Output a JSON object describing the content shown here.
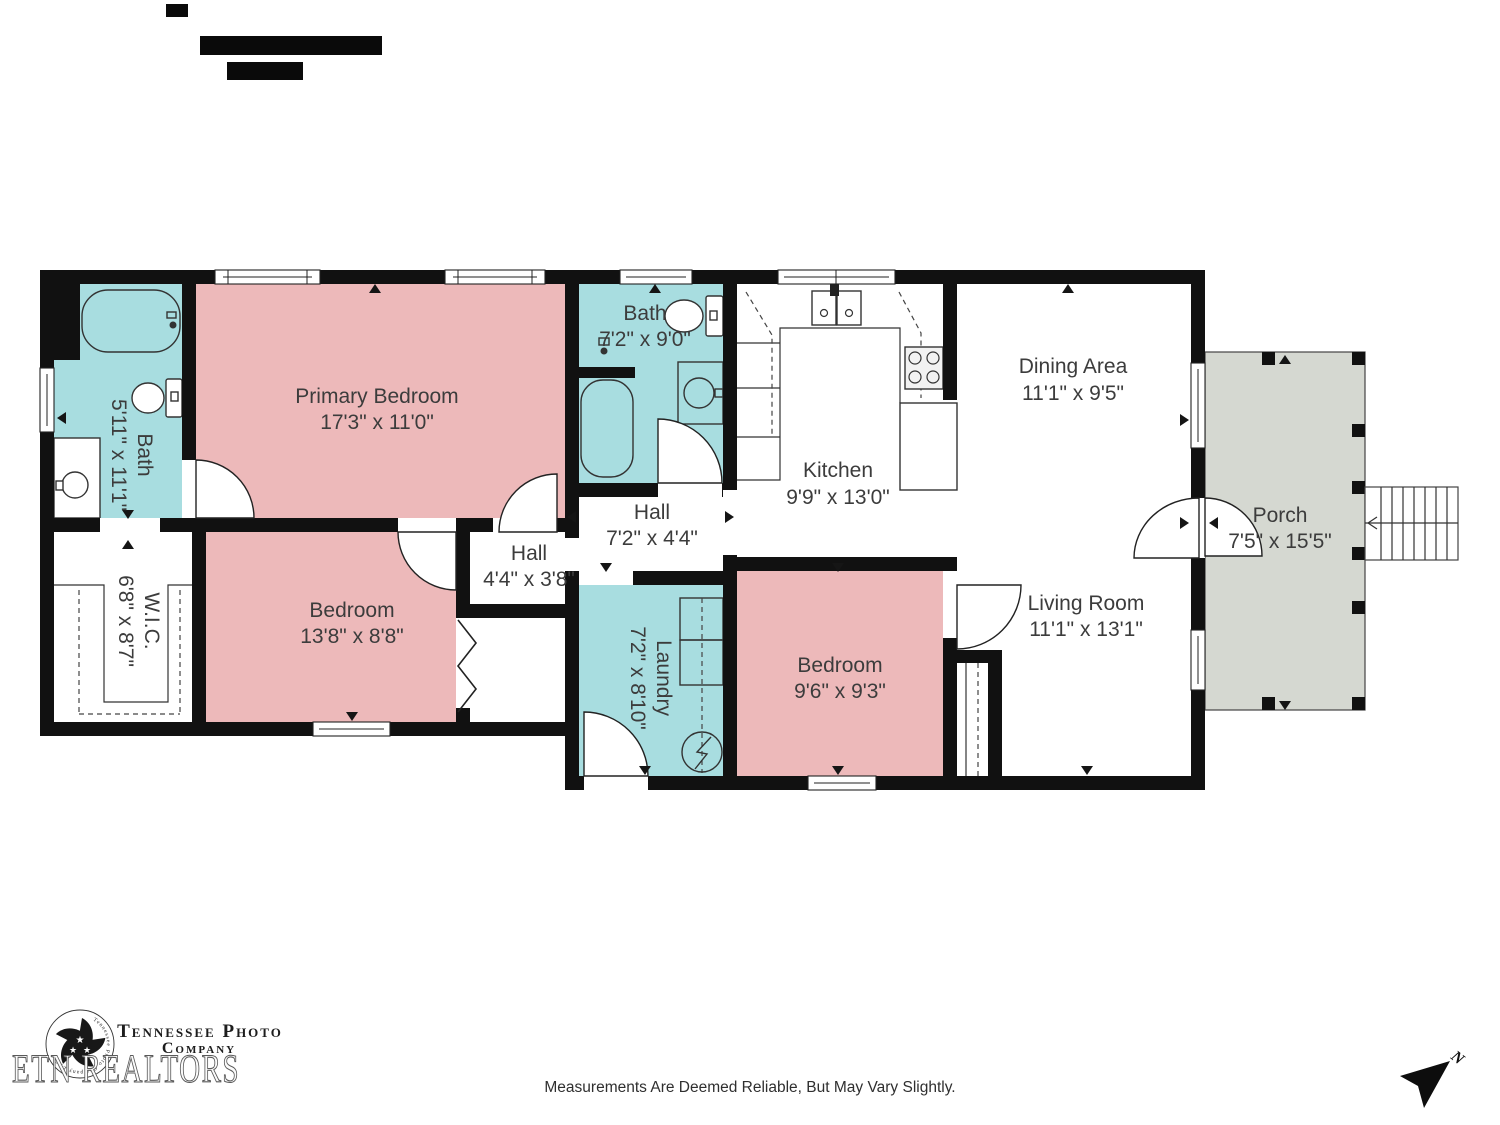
{
  "rooms": [
    {
      "name": "Bath",
      "dims": "5'11\" x 11'1\""
    },
    {
      "name": "Primary Bedroom",
      "dims": "17'3\" x 11'0\""
    },
    {
      "name": "Bath",
      "dims": "7'2\" x 9'0\""
    },
    {
      "name": "Kitchen",
      "dims": "9'9\" x 13'0\""
    },
    {
      "name": "Dining Area",
      "dims": "11'1\" x 9'5\""
    },
    {
      "name": "Hall",
      "dims": "7'2\" x 4'4\""
    },
    {
      "name": "Hall",
      "dims": "4'4\" x 3'8\""
    },
    {
      "name": "W.I.C.",
      "dims": "6'8\" x 8'7\""
    },
    {
      "name": "Bedroom",
      "dims": "13'8\" x 8'8\""
    },
    {
      "name": "Laundry",
      "dims": "7'2\" x 8'10\""
    },
    {
      "name": "Bedroom",
      "dims": "9'6\" x 9'3\""
    },
    {
      "name": "Living Room",
      "dims": "11'1\" x 13'1\""
    },
    {
      "name": "Porch",
      "dims": "7'5\" x 15'5\""
    }
  ],
  "branding": {
    "company_line1": "Tennessee Photo",
    "company_line2": "Company",
    "logo_ring_text": "Tennessee Photo Company LLC",
    "watermark": "ETN REALTORS"
  },
  "footer": {
    "disclaimer": "Measurements Are Deemed Reliable, But May Vary Slightly."
  },
  "compass": {
    "north_label": "N"
  },
  "colors": {
    "wall": "#111111",
    "bedroom_pink": "#edb9ba",
    "bath_teal": "#a8dde0",
    "porch_gray": "#d5d8d1",
    "label_text": "#3c3c3c"
  }
}
